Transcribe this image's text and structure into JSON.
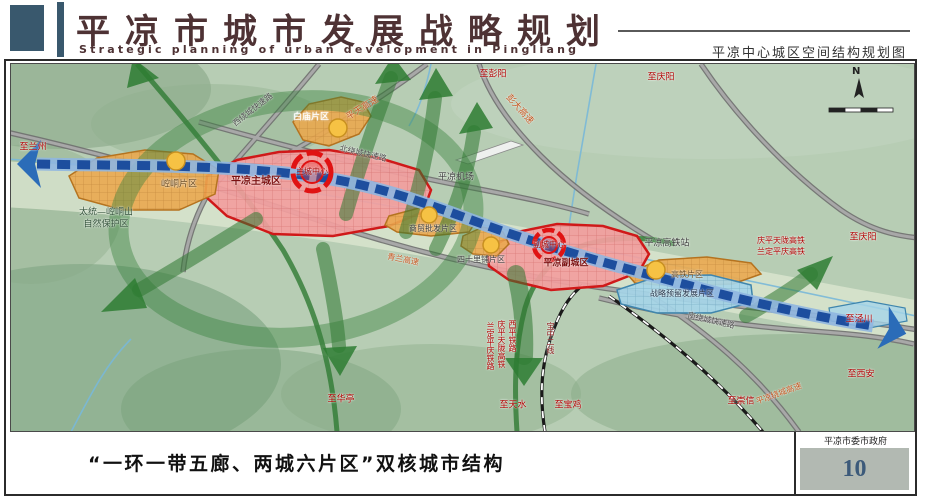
{
  "header": {
    "title_cn": "平凉市城市发展战略规划",
    "title_en": "Strategic planning of urban development in Pingliang",
    "right_caption": "平凉中心城区空间结构规划图"
  },
  "footer": {
    "caption": "“一环一带五廊、两城六片区”双核城市结构",
    "authority": "平凉市委市政府",
    "page_number": "10"
  },
  "colors": {
    "zone_red_stroke": "#d01818",
    "zone_pink_fill": "#f29e9e",
    "zone_orange_fill": "#eaa94f",
    "zone_blue_fill": "#a5d5e8",
    "axis_blue": "#1d4e9e",
    "corridor_green": "#2f7a33",
    "header_logo": "#39586d",
    "page_number_color": "#3c5a7a"
  },
  "map": {
    "compass_label": "N",
    "labels": [
      {
        "text": "至兰州",
        "x": 22,
        "y": 84,
        "color": "#b00000",
        "size": 9
      },
      {
        "text": "至彭阳",
        "x": 482,
        "y": 11,
        "color": "#b00000",
        "size": 9
      },
      {
        "text": "至庆阳",
        "x": 650,
        "y": 14,
        "color": "#b00000",
        "size": 9
      },
      {
        "text": "至庆阳",
        "x": 852,
        "y": 174,
        "color": "#b00000",
        "size": 9
      },
      {
        "text": "至泾川",
        "x": 848,
        "y": 256,
        "color": "#b00000",
        "size": 9
      },
      {
        "text": "至西安",
        "x": 850,
        "y": 311,
        "color": "#b00000",
        "size": 9
      },
      {
        "text": "至崇信",
        "x": 730,
        "y": 338,
        "color": "#b00000",
        "size": 9
      },
      {
        "text": "至天水",
        "x": 502,
        "y": 342,
        "color": "#b00000",
        "size": 9
      },
      {
        "text": "至宝鸡",
        "x": 557,
        "y": 342,
        "color": "#b00000",
        "size": 9
      },
      {
        "text": "至华亭",
        "x": 330,
        "y": 336,
        "color": "#b00000",
        "size": 9
      },
      {
        "text": "西绕城快速路",
        "x": 242,
        "y": 46,
        "rot": -38,
        "color": "#4a4a4a",
        "size": 8
      },
      {
        "text": "平天高速",
        "x": 352,
        "y": 45,
        "rot": -32,
        "color": "#c2551e",
        "size": 9
      },
      {
        "text": "彭大高速",
        "x": 508,
        "y": 46,
        "rot": 48,
        "color": "#c2551e",
        "size": 9
      },
      {
        "text": "北绕城快速路",
        "x": 352,
        "y": 90,
        "rot": 13,
        "color": "#4a4a4a",
        "size": 8
      },
      {
        "text": "青兰高速",
        "x": 392,
        "y": 196,
        "rot": 11,
        "color": "#c2551e",
        "size": 8
      },
      {
        "text": "南绕城快速路",
        "x": 700,
        "y": 257,
        "rot": 13,
        "color": "#4a4a4a",
        "size": 8
      },
      {
        "text": "平凉绕城高速",
        "x": 768,
        "y": 330,
        "rot": -20,
        "color": "#c2551e",
        "size": 8
      },
      {
        "text": "白庙片区",
        "x": 300,
        "y": 54,
        "color": "#ffffff",
        "size": 9
      },
      {
        "text": "崆峒片区",
        "x": 168,
        "y": 121,
        "color": "#6b4a1e",
        "size": 9
      },
      {
        "text": "太统—崆峒山",
        "x": 95,
        "y": 149,
        "color": "#33523a",
        "size": 9
      },
      {
        "text": "自然保护区",
        "x": 95,
        "y": 161,
        "color": "#33523a",
        "size": 9
      },
      {
        "text": "平凉主城区",
        "x": 245,
        "y": 118,
        "color": "#7c1010",
        "size": 10,
        "bold": true
      },
      {
        "text": "主城中心",
        "x": 301,
        "y": 108,
        "color": "#a00000",
        "size": 8
      },
      {
        "text": "平凉机场",
        "x": 445,
        "y": 114,
        "color": "#3a3a3a",
        "size": 9
      },
      {
        "text": "商贸批发片区",
        "x": 422,
        "y": 165,
        "color": "#3a3a3a",
        "size": 8
      },
      {
        "text": "四十里铺片区",
        "x": 470,
        "y": 196,
        "color": "#3a3a3a",
        "size": 8
      },
      {
        "text": "副城中心",
        "x": 538,
        "y": 181,
        "color": "#a00000",
        "size": 8
      },
      {
        "text": "平凉副城区",
        "x": 555,
        "y": 200,
        "color": "#7c1010",
        "size": 9,
        "bold": true
      },
      {
        "text": "平凉高铁站",
        "x": 656,
        "y": 180,
        "color": "#3a3a3a",
        "size": 9
      },
      {
        "text": "庆平天陇高铁",
        "x": 770,
        "y": 177,
        "color": "#b00000",
        "size": 8
      },
      {
        "text": "兰定平庆高铁",
        "x": 770,
        "y": 188,
        "color": "#b00000",
        "size": 8
      },
      {
        "text": "高铁片区",
        "x": 676,
        "y": 211,
        "color": "#6b4a1e",
        "size": 8
      },
      {
        "text": "战略预留发展片区",
        "x": 671,
        "y": 230,
        "color": "#24344a",
        "size": 8
      },
      {
        "text": "兰定平庆铁路",
        "x": 479,
        "y": 282,
        "color": "#b00000",
        "size": 8,
        "vertical": true
      },
      {
        "text": "庆平天陇高铁",
        "x": 490,
        "y": 280,
        "color": "#b00000",
        "size": 8,
        "vertical": true
      },
      {
        "text": "西平铁路",
        "x": 501,
        "y": 272,
        "color": "#b00000",
        "size": 8,
        "vertical": true
      },
      {
        "text": "宝中二线",
        "x": 539,
        "y": 274,
        "color": "#8b1a1a",
        "size": 8,
        "vertical": true
      }
    ]
  }
}
